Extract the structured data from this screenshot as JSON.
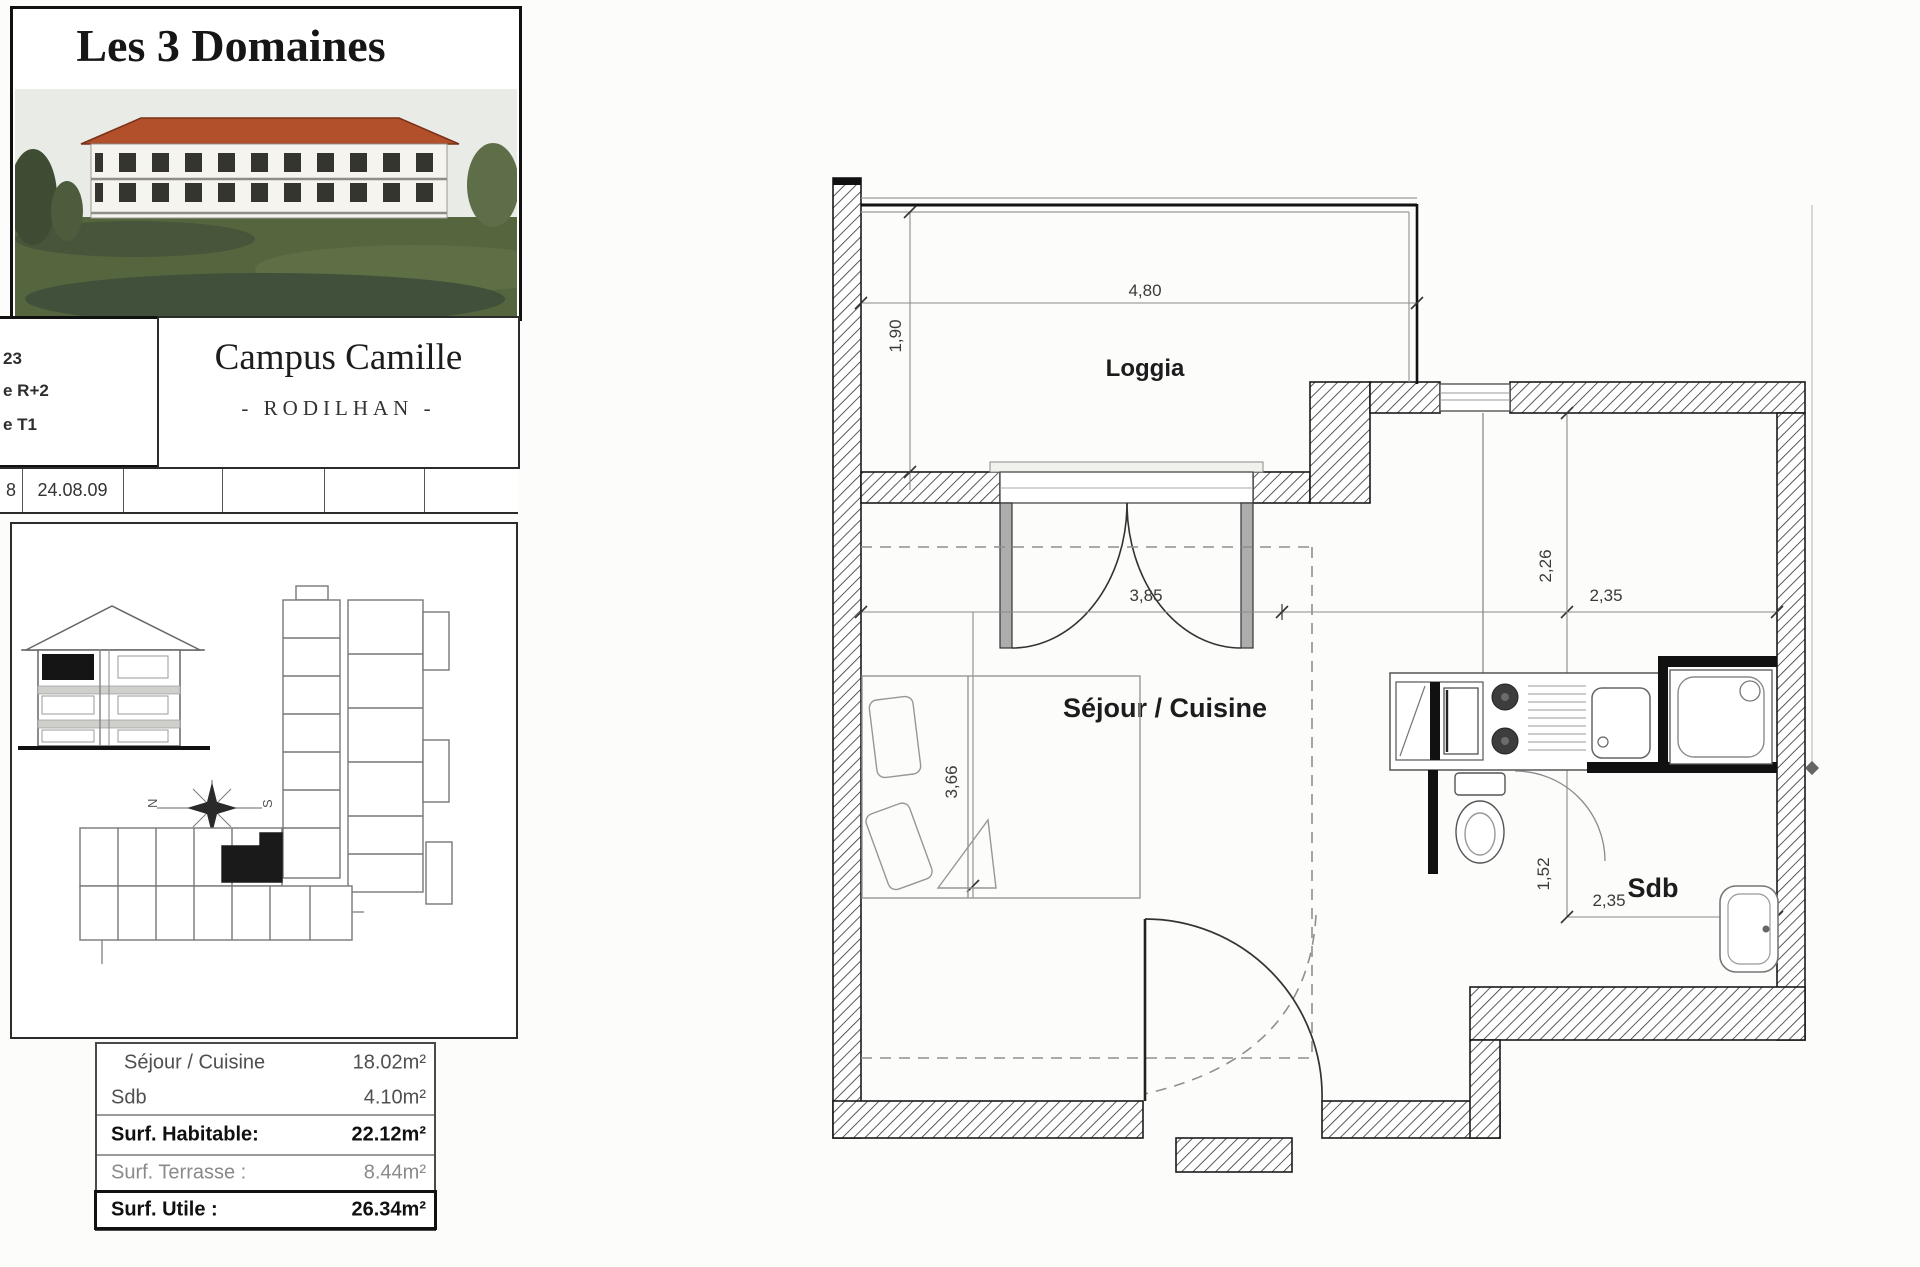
{
  "sidebar": {
    "title": "Les 3 Domaines",
    "campus": {
      "name": "Campus Camille",
      "city": "- RODILHAN -"
    },
    "meta": {
      "line1": "23",
      "line2": "e R+2",
      "line3": "e T1"
    },
    "date_row": {
      "c1": "8",
      "c2": "24.08.09"
    },
    "compass": {
      "west": "N",
      "east": "S"
    },
    "areas": {
      "rows": [
        {
          "label": "Séjour / Cuisine",
          "value": "18.02m²"
        },
        {
          "label": "Sdb",
          "value": "4.10m²"
        },
        {
          "label": "Surf. Habitable:",
          "value": "22.12m²"
        },
        {
          "label": "Surf. Terrasse :",
          "value": "8.44m²"
        },
        {
          "label": "Surf. Utile :",
          "value": "26.34m²"
        }
      ]
    }
  },
  "plan": {
    "rooms": {
      "loggia": "Loggia",
      "sejour": "Séjour / Cuisine",
      "sdb": "Sdb"
    },
    "dimensions": {
      "loggia_width": "4,80",
      "loggia_depth": "1,90",
      "sejour_width": "3,85",
      "sejour_depth": "3,66",
      "sdb_depth_upper": "2,26",
      "sdb_width_upper": "2,35",
      "sdb_depth_lower": "1,52",
      "sdb_width_lower": "2,35"
    }
  }
}
